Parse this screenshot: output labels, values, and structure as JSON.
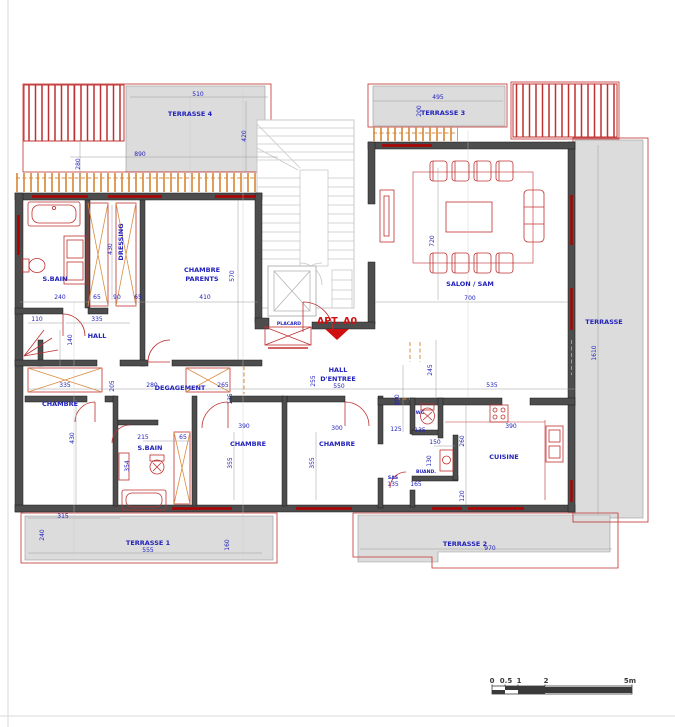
{
  "apartment_label": "APT. A0",
  "rooms": {
    "terrasse4": "TERRASSE 4",
    "terrasse3": "TERRASSE 3",
    "terrasse_right": "TERRASSE",
    "terrasse1": "TERRASSE 1",
    "terrasse2": "TERRASSE 2",
    "sbain_master": "S.BAIN",
    "dressing": "DRESSING",
    "chambre_parents_1": "CHAMBRE",
    "chambre_parents_2": "PARENTS",
    "hall": "HALL",
    "hall_entree_1": "HALL",
    "hall_entree_2": "D'ENTREE",
    "degagement": "DEGAGEMENT",
    "chambre1": "CHAMBRE",
    "sbain2": "S.BAIN",
    "chambre2": "CHAMBRE",
    "chambre3": "CHAMBRE",
    "sas": "SAS",
    "wc": "WC",
    "buand": "BUAND.",
    "cuisine": "CUISINE",
    "salon": "SALON / SAM",
    "placard": "PLACARD"
  },
  "dims": [
    "510",
    "890",
    "420",
    "280",
    "495",
    "200",
    "240",
    "65",
    "90",
    "65",
    "410",
    "430",
    "570",
    "110",
    "335",
    "140",
    "720",
    "700",
    "245",
    "535",
    "550",
    "255",
    "390",
    "335",
    "205",
    "280",
    "265",
    "135",
    "430",
    "390",
    "355",
    "300",
    "355",
    "125",
    "135",
    "215",
    "65",
    "354",
    "150",
    "130",
    "165",
    "120",
    "260",
    "390",
    "315",
    "240",
    "555",
    "160",
    "970",
    "1610",
    "135"
  ],
  "scale_bar": {
    "labels": [
      "0",
      "0.5",
      "1",
      "2",
      "5m"
    ]
  },
  "colors": {
    "wall": "#4d4d4d",
    "blue": "#2222bb",
    "red": "#c03030",
    "orange": "#d98c3f",
    "terrace": "#dcdcdc",
    "stair": "#c9c9c9"
  }
}
